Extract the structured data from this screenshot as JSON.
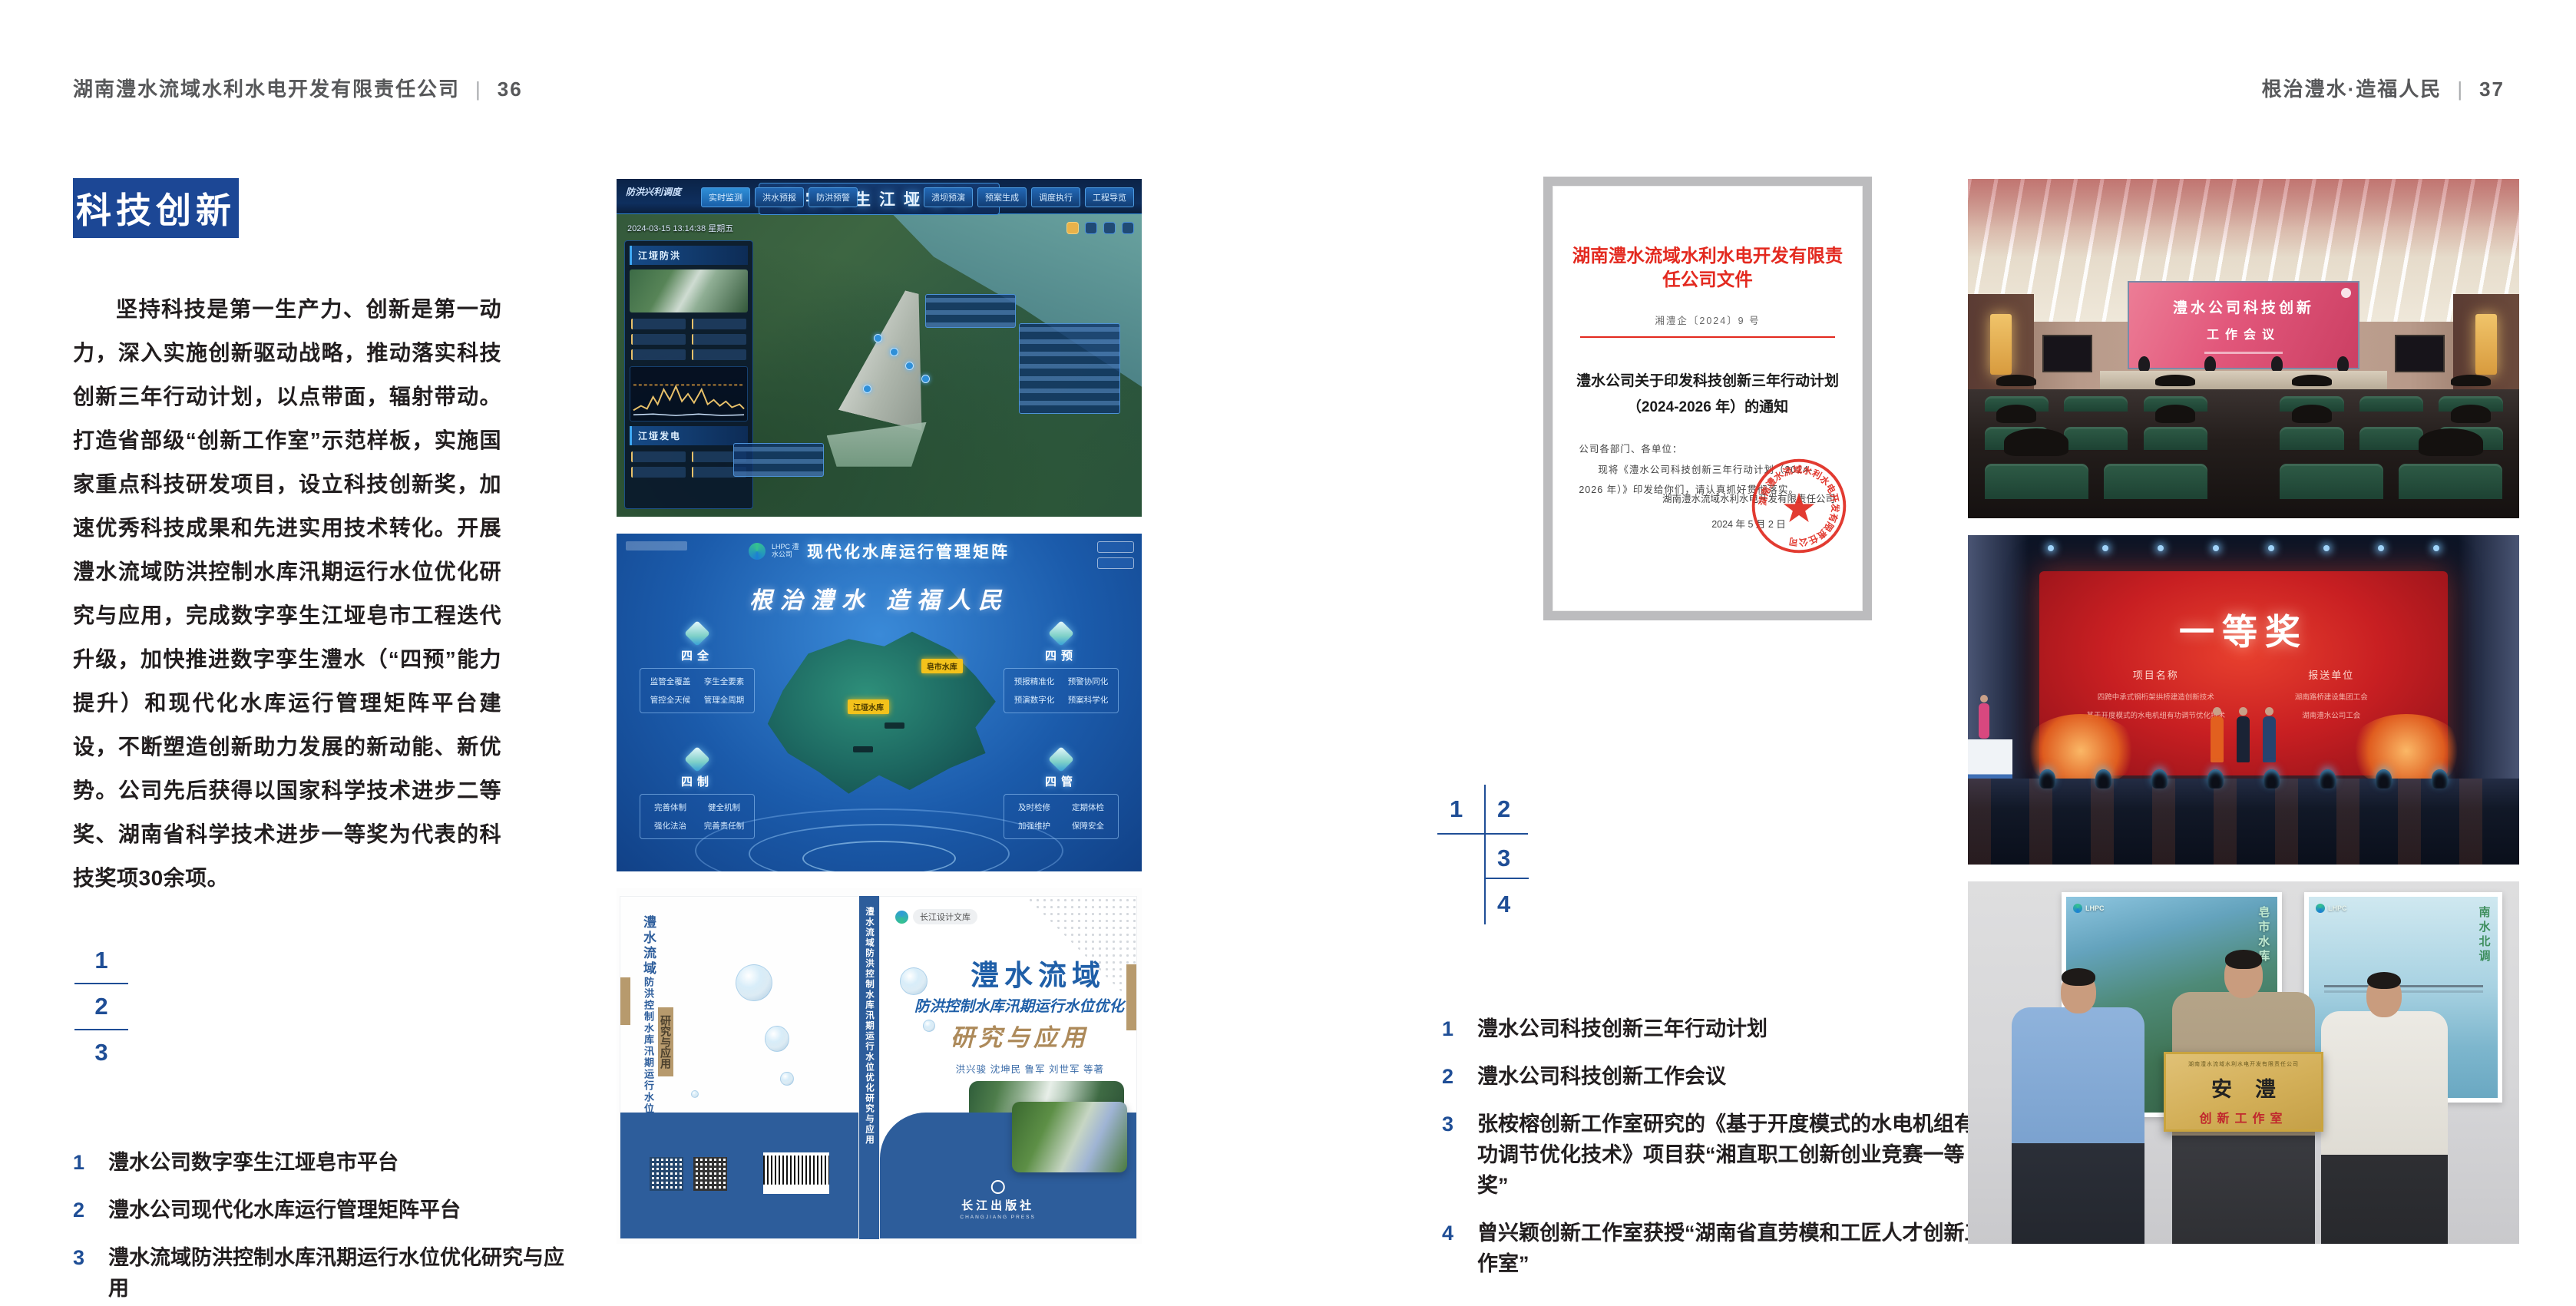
{
  "colors": {
    "accent_blue": "#1c4795",
    "index_blue": "#1f4e96",
    "document_red": "#e3291f",
    "book_band_blue": "#2d5d9b"
  },
  "page_left": {
    "header": {
      "title": "湖南澧水流域水利水电开发有限责任公司",
      "divider": "|",
      "page_no": "36"
    },
    "badge": "科技创新",
    "paragraph": "坚持科技是第一生产力、创新是第一动力，深入实施创新驱动战略，推动落实科技创新三年行动计划，以点带面，辐射带动。打造省部级“创新工作室”示范样板，实施国家重点科技研发项目，设立科技创新奖，加速优秀科技成果和先进实用技术转化。开展澧水流域防洪控制水库汛期运行水位优化研究与应用，完成数字孪生江垭皂市工程迭代升级，加快推进数字孪生澧水（“四预”能力提升）和现代化水库运行管理矩阵平台建设，不断塑造创新助力发展的新动能、新优势。公司先后获得以国家科学技术进步二等奖、湖南省科学技术进步一等奖为代表的科技奖项30余项。",
    "figure_index": [
      "1",
      "2",
      "3"
    ],
    "captions": [
      {
        "num": "1",
        "text": "澧水公司数字孪生江垭皂市平台"
      },
      {
        "num": "2",
        "text": "澧水公司现代化水库运行管理矩阵平台"
      },
      {
        "num": "3",
        "text": "澧水流域防洪控制水库汛期运行水位优化研究与应用"
      }
    ]
  },
  "page_right": {
    "header": {
      "title": "根治澧水·造福人民",
      "divider": "|",
      "page_no": "37"
    },
    "figure_index": [
      "1",
      "2",
      "3",
      "4"
    ],
    "captions": [
      {
        "num": "1",
        "text": "澧水公司科技创新三年行动计划"
      },
      {
        "num": "2",
        "text": "澧水公司科技创新工作会议"
      },
      {
        "num": "3",
        "text": "张桉榕创新工作室研究的《基于开度模式的水电机组有功调节优化技术》项目获“湘直职工创新创业竞赛一等奖”"
      },
      {
        "num": "4",
        "text": "曾兴颖创新工作室获授“湖南省直劳模和工匠人才创新工作室”"
      }
    ]
  },
  "fig_dashboard": {
    "title": "数字孪生江垭皂市",
    "datetime": "2024-03-15 13:14:38 星期五",
    "module_label": "防洪兴利调度",
    "tabs_left": [
      "实时监测",
      "洪水预报",
      "防洪预警"
    ],
    "tabs_right": [
      "溃坝预演",
      "预案生成",
      "调度执行",
      "工程导览"
    ],
    "panel_flood": "江垭防洪",
    "panel_power": "江垭发电"
  },
  "fig_matrix": {
    "logo": "LHPC 澧水公司",
    "title": "现代化水库运行管理矩阵",
    "slogan": "根治澧水 造福人民",
    "corner_cards": [
      {
        "label": "四全",
        "items": [
          "监管全覆盖",
          "孪生全要素",
          "管控全天候",
          "管理全周期"
        ]
      },
      {
        "label": "四预",
        "items": [
          "预报精准化",
          "预警协同化",
          "预演数字化",
          "预案科学化"
        ]
      },
      {
        "label": "四制",
        "items": [
          "完善体制",
          "健全机制",
          "强化法治",
          "完善责任制"
        ]
      },
      {
        "label": "四管",
        "items": [
          "及时检修",
          "定期体检",
          "加强维护",
          "保障安全"
        ]
      }
    ],
    "markers": [
      "皂市水库",
      "江垭水库"
    ]
  },
  "fig_book": {
    "series_badge": "长江设计文库",
    "title_region": "澧水流域",
    "title_sub": "防洪控制水库汛期运行水位优化",
    "title_tail": "研究与应用",
    "authors": "洪兴骏 沈坤民 鲁军 刘世军 等著",
    "publisher": "长江出版社",
    "publisher_en": "CHANGJIANG PRESS",
    "spine_text": "澧水流域防洪控制水库汛期运行水位优化研究与应用",
    "back_title_1": "澧水流域",
    "back_title_2": "防洪控制水库汛期运行水位优化",
    "back_title_3": "研究与应用"
  },
  "fig_document": {
    "masthead": "湖南澧水流域水利水电开发有限责任公司文件",
    "doc_no": "湘澧企〔2024〕9 号",
    "subject_1": "澧水公司关于印发科技创新三年行动计划",
    "subject_2": "（2024-2026 年）的通知",
    "salutation": "公司各部门、各单位：",
    "body": "现将《澧水公司科技创新三年行动计划（2024-2026 年）》印发给你们，请认真抓好贯彻落实。",
    "signature": "湖南澧水流域水利水电开发有限责任公司",
    "date": "2024 年 5 月 2 日",
    "seal_text": "湖南澧水流域水利水电开发有限责任公司"
  },
  "fig_meeting": {
    "screen_line1": "澧水公司科技创新",
    "screen_line2": "工作会议"
  },
  "fig_award": {
    "headline": "一等奖",
    "col1": "项目名称",
    "col2": "报送单位",
    "rows": [
      [
        "四跨中承式钢桁架拱桥建造创新技术",
        "湖南路桥建设集团工会"
      ],
      [
        "基于开度模式的水电机组有功调节优化技术",
        "湖南澧水公司工会"
      ]
    ]
  },
  "fig_plaque": {
    "plaque_header": "湖南澧水流域水利水电开发有限责任公司",
    "plaque_main": "安澧",
    "plaque_sub": "创新工作室",
    "poster_logo": "LHPC",
    "poster_left_text": "皂市水库",
    "poster_right_text": "南水北调"
  }
}
